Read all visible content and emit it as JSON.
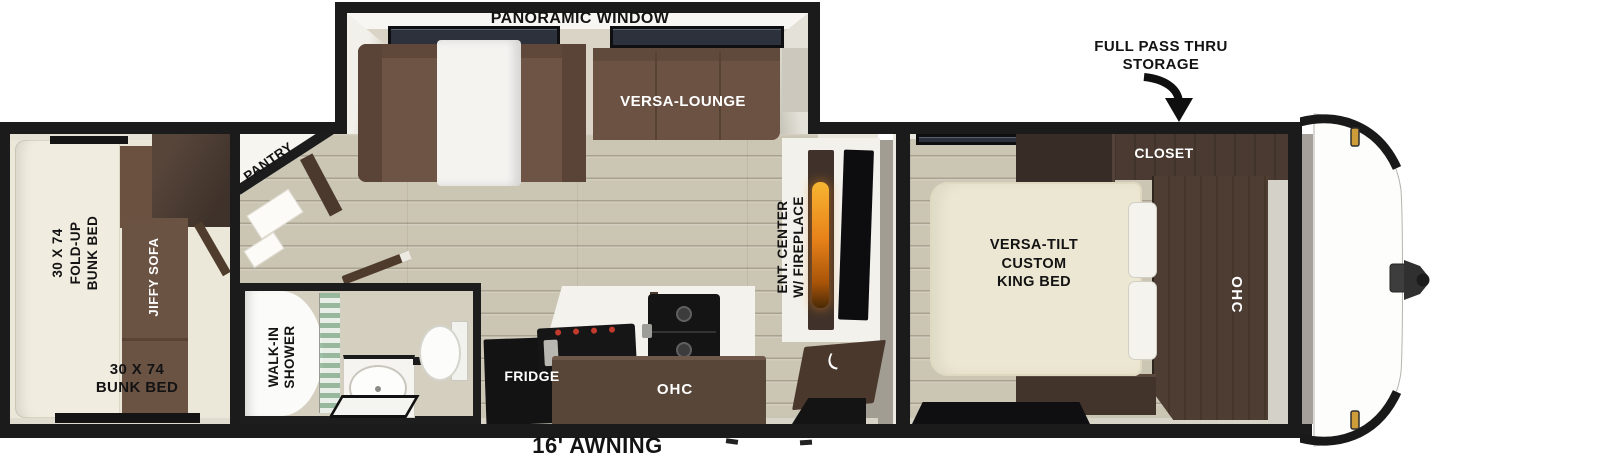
{
  "areas": {
    "slideout": {
      "window_label": "PANORAMIC WINDOW",
      "lounge_label": "VERSA-LOUNGE"
    },
    "bunk_room": {
      "fold_up_bunk_label": "30 X 74\nFOLD-UP\nBUNK BED",
      "sofa_label": "JIFFY SOFA",
      "bunk_bed_label": "30 X 74\nBUNK BED"
    },
    "pantry": {
      "label": "PANTRY"
    },
    "bathroom": {
      "shower_label": "WALK-IN\nSHOWER"
    },
    "kitchen": {
      "fridge_label": "FRIDGE",
      "ohc_label": "OHC"
    },
    "living_room": {
      "ent_center_label": "ENT. CENTER\nW/ FIREPLACE"
    },
    "bedroom": {
      "bed_label": "VERSA-TILT\nCUSTOM\nKING BED",
      "closet_label": "CLOSET",
      "ohc_label": "OHC"
    },
    "exterior": {
      "pass_thru_label": "FULL PASS THRU\nSTORAGE",
      "awning_label": "16' AWNING"
    }
  },
  "icons": {
    "pass_thru_arrow": "curved-arrow-down"
  },
  "colors": {
    "wall": "#1b1b1b",
    "sofa_brown": "#6b5243",
    "cabinet_brown": "#483a30",
    "bed_cream": "#ebe7d2",
    "floor_tan": "#cbc5b4",
    "appliance_black": "#141414",
    "flame_orange": "#e8821a",
    "burner_red": "#c23a2c",
    "glass_green": "#9cc4a8",
    "marker_amber": "#cf9c3a"
  }
}
